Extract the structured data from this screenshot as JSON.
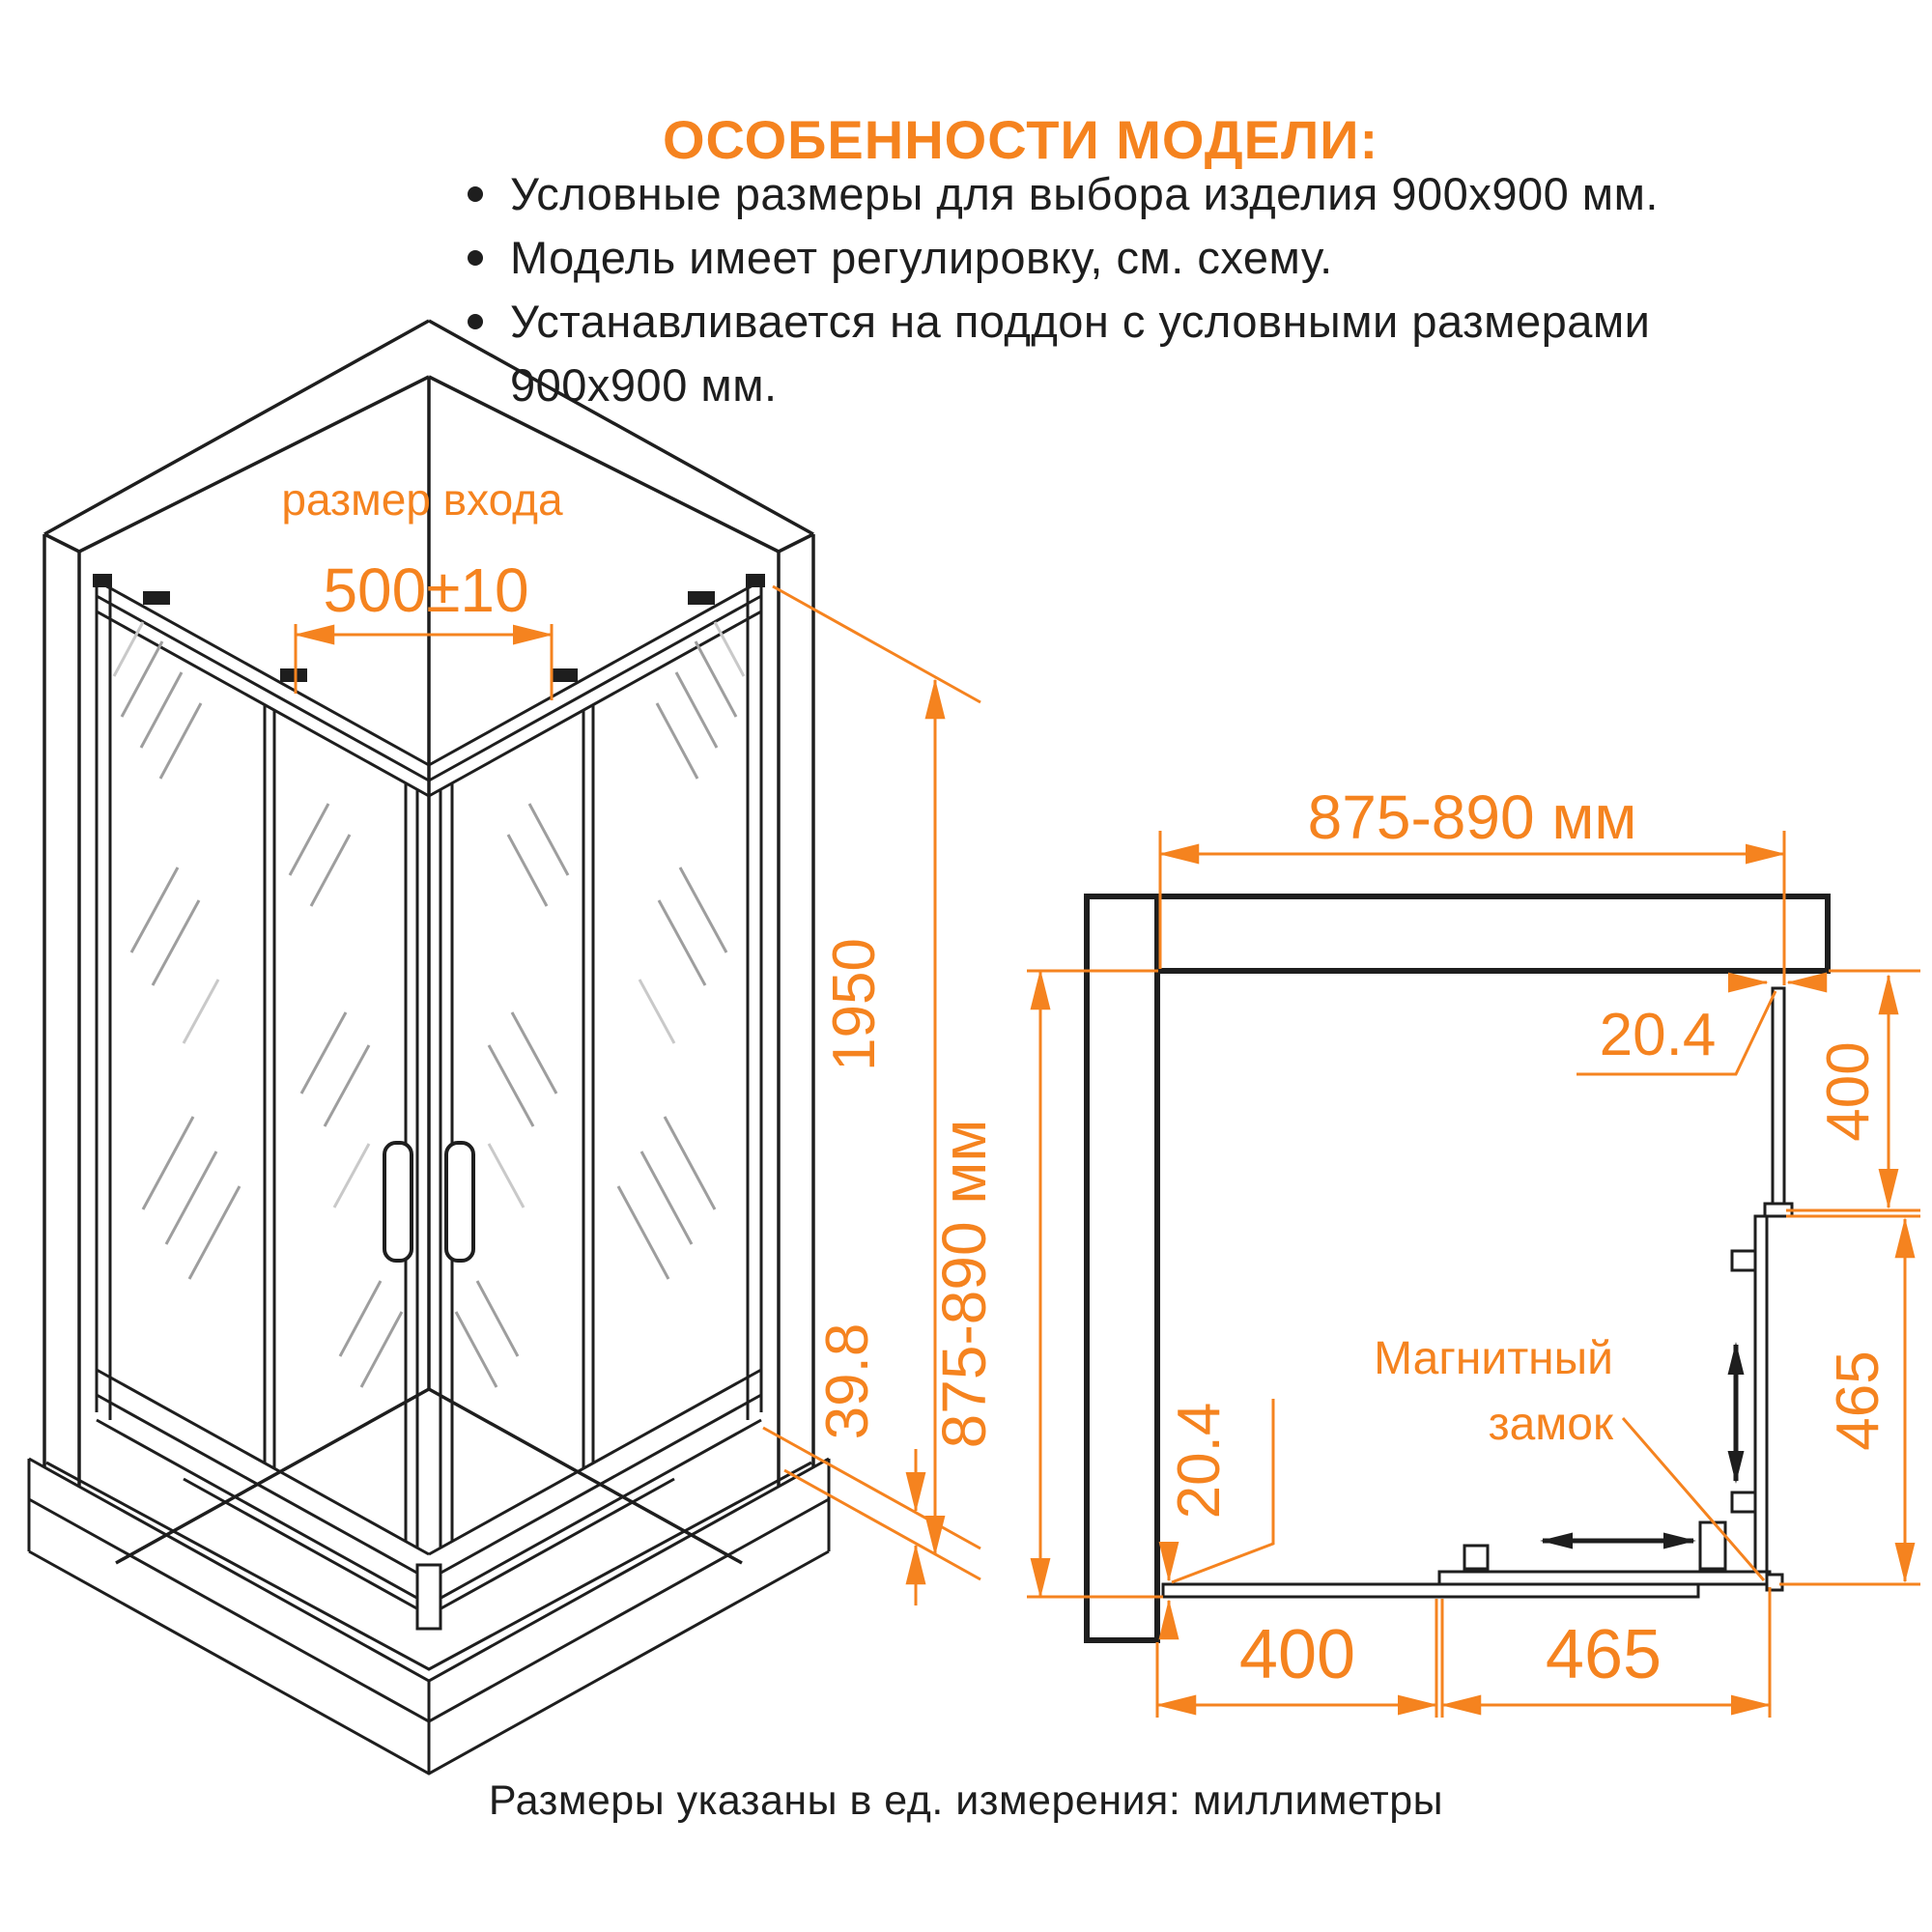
{
  "header": {
    "title": "ОСОБЕННОСТИ МОДЕЛИ:",
    "bullets": [
      "Условные размеры для выбора изделия 900x900 мм.",
      "Модель имеет регулировку, см. схему.",
      "Устанавливается на поддон с условными размерами 900x900 мм."
    ]
  },
  "footer": {
    "note": "Размеры указаны в ед. измерения: миллиметры"
  },
  "colors": {
    "accent": "#f5831f",
    "line": "#1e1e1e",
    "hatch": "#9e9e9e"
  },
  "iso_view": {
    "entry_label": "размер входа",
    "entry_dim": "500±10",
    "height_dim": "1950",
    "profile_dim": "39.8"
  },
  "plan_view": {
    "width_dim": "875-890 мм",
    "depth_dim": "875-890 мм",
    "top_gap_dim": "20.4",
    "side_fixed_dim": "400",
    "side_door_dim": "465",
    "bottom_gap_dim": "20.4",
    "bottom_fixed_dim": "400",
    "bottom_door_dim": "465",
    "lock_label_1": "Магнитный",
    "lock_label_2": "замок"
  }
}
